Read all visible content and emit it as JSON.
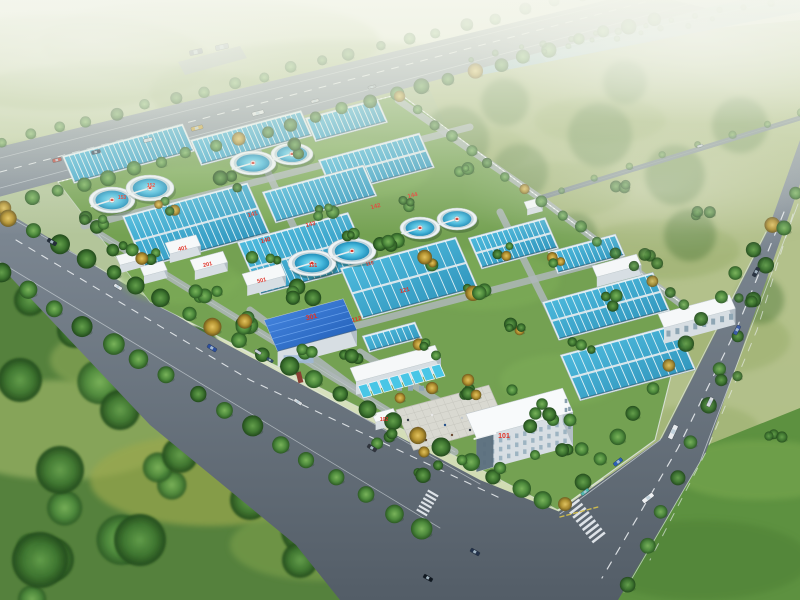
{
  "scene": {
    "subject": "aerial rendering of a wastewater treatment plant",
    "view": "bird's-eye perspective"
  },
  "unit_labels": [
    {
      "id": "admin-building",
      "text": "101"
    },
    {
      "id": "gate-house",
      "text": "102"
    },
    {
      "id": "building-201",
      "text": "201"
    },
    {
      "id": "workshop-301",
      "text": "301"
    },
    {
      "id": "building-401",
      "text": "401"
    },
    {
      "id": "building-501",
      "text": "501"
    },
    {
      "id": "basin-140",
      "text": "140"
    },
    {
      "id": "basin-141",
      "text": "141"
    },
    {
      "id": "basin-142",
      "text": "142"
    },
    {
      "id": "basin-143",
      "text": "143"
    },
    {
      "id": "basin-144",
      "text": "144"
    },
    {
      "id": "basin-121",
      "text": "121"
    },
    {
      "id": "basin-112",
      "text": "112"
    },
    {
      "id": "unit-110",
      "text": "110"
    },
    {
      "id": "clarifier-153",
      "text": "153"
    },
    {
      "id": "clarifier-152",
      "text": "152"
    },
    {
      "id": "clarifier-151",
      "text": "151"
    }
  ],
  "colors": {
    "label_red": "#e03226",
    "basin_water": "#3fb2da",
    "clarifier_water": "#2aa3cf",
    "blue_roof": "#2f6fd0",
    "road": "#68737e",
    "plant_grass": "#74a152",
    "forest": "#3c6c30",
    "field": "#b7c78e",
    "river": "#9cc0cf",
    "haze": "#f2f4ea",
    "building_white": "#f2f5f7",
    "plaza": "#d9d9d1"
  }
}
